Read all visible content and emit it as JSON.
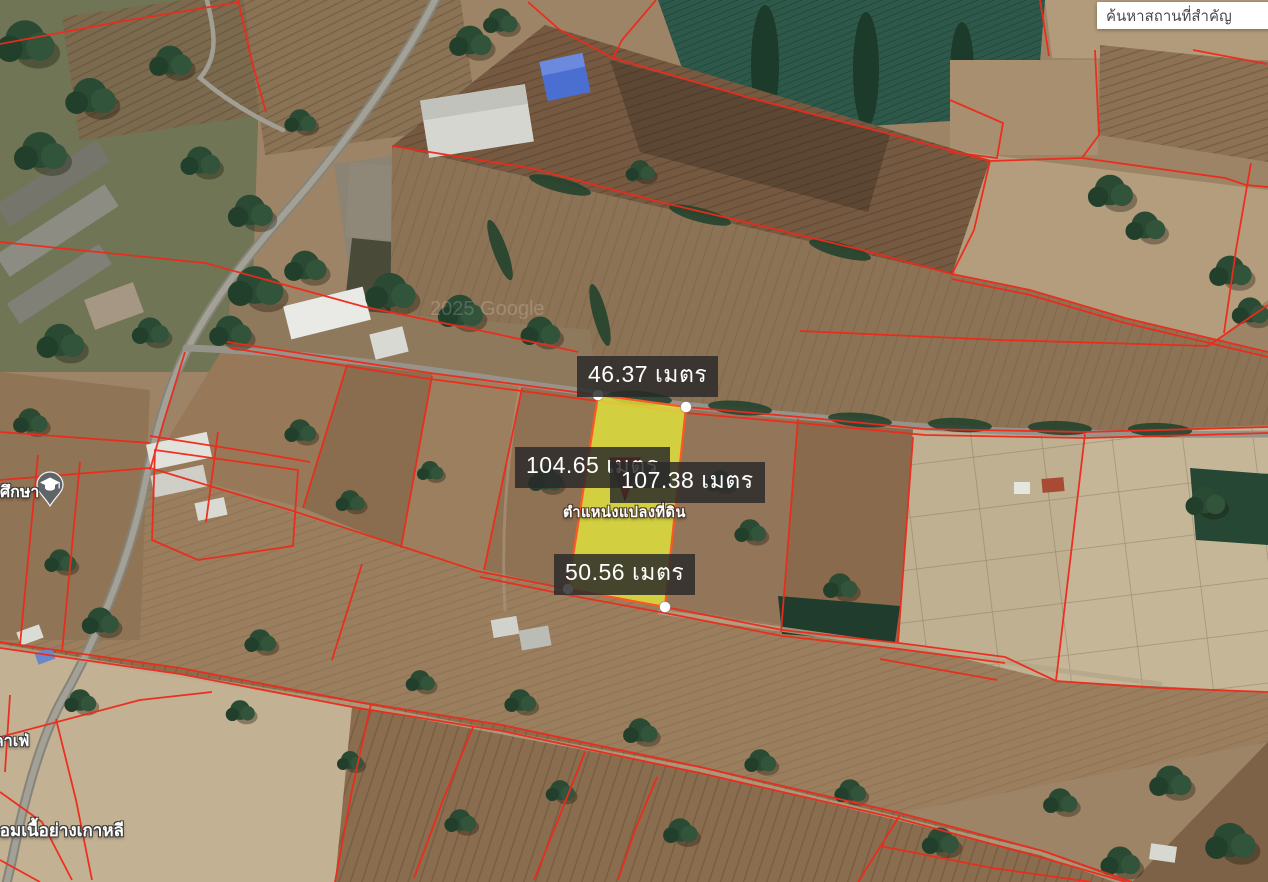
{
  "search": {
    "value": "ค้นหาสถานที่สำคัญ"
  },
  "measurements": {
    "top": "46.37 เมตร",
    "west": "104.65 เมตร",
    "east": "107.38 เมตร",
    "bottom": "50.56 เมตร"
  },
  "parcel": {
    "marker_label": "ตำแหน่งแปลงที่ดิน",
    "highlight_color": "#e7ea3c",
    "outline_color": "#ff5722",
    "corner_dot_color": "#ffffff",
    "marker_color": "#e51408"
  },
  "cadastral": {
    "line_color": "#ee2a1b"
  },
  "pois": {
    "school": "ศึกษา",
    "cafe": "คาเฟ่",
    "restaurant": "เอมเนื้อย่างเกาหลี"
  },
  "watermark": "2025 Google"
}
